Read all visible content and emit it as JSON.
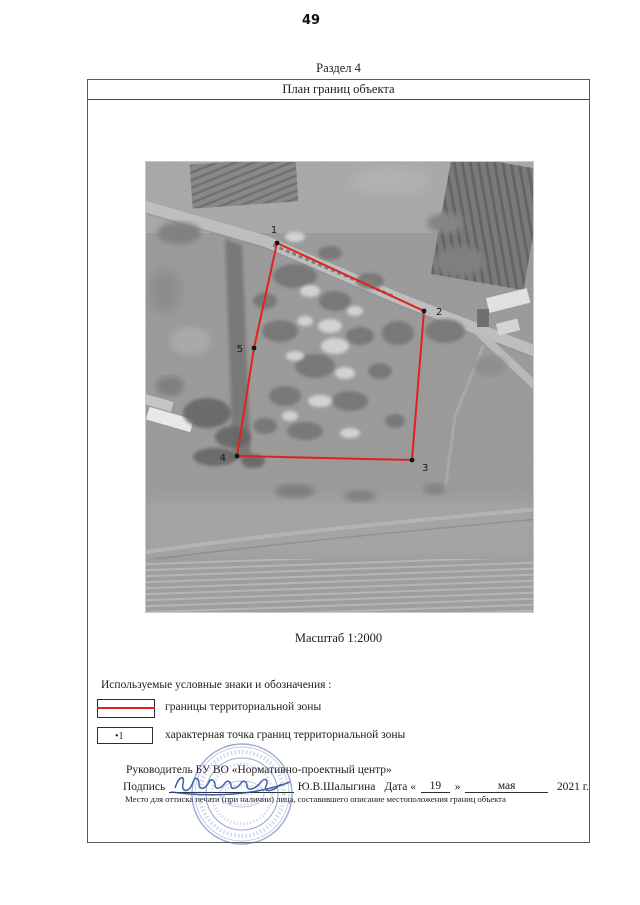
{
  "page_number": "49",
  "section_title": "Раздел 4",
  "plan": {
    "title": "План границ объекта",
    "scale": "Масштаб 1:2000"
  },
  "map": {
    "boundary_color": "#e32020",
    "point_color": "#141414",
    "points": [
      {
        "label": "1",
        "x": 132,
        "y": 82,
        "lx": 129,
        "ly": 72,
        "anchor": "middle"
      },
      {
        "label": "2",
        "x": 279,
        "y": 150,
        "lx": 291,
        "ly": 154,
        "anchor": "start"
      },
      {
        "label": "3",
        "x": 267,
        "y": 299,
        "lx": 277,
        "ly": 310,
        "anchor": "start"
      },
      {
        "label": "4",
        "x": 92,
        "y": 295,
        "lx": 81,
        "ly": 300,
        "anchor": "end"
      },
      {
        "label": "5",
        "x": 109,
        "y": 187,
        "lx": 98,
        "ly": 191,
        "anchor": "end"
      }
    ],
    "polygon_order": [
      0,
      1,
      2,
      3,
      4
    ]
  },
  "legend": {
    "heading": "Используемые условные знаки и обозначения :",
    "items": [
      {
        "symbol": "boundary-line",
        "symbol_text": "",
        "label": "границы территориальной зоны"
      },
      {
        "symbol": "characteristic-point",
        "symbol_text": "•1",
        "label": "характерная точка границ территориальной зоны"
      }
    ]
  },
  "signature": {
    "head": "Руководитель БУ ВО «Нормативно-проектный центр»",
    "sign_label": "Подпись",
    "name": "Ю.В.Шалыгина",
    "date_label": "Дата «",
    "day": "19",
    "quote_close": "»",
    "month": "мая",
    "year": "2021 г.",
    "stamp_note": "Место для оттиска печати (при наличии) лица, составившего описание местоположения границ объекта"
  }
}
